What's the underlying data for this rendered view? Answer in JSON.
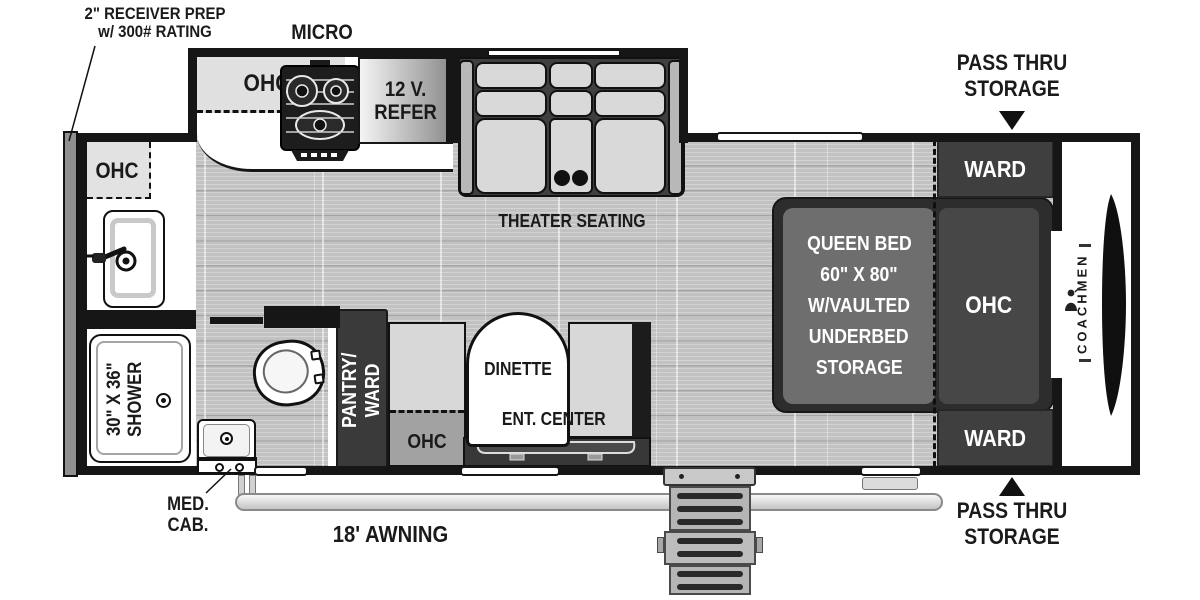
{
  "floorplan": {
    "brand": "COACHMEN",
    "annotations": {
      "receiver_prep": [
        "2\" RECEIVER PREP",
        "w/ 300# RATING"
      ],
      "micro": "MICRO",
      "pass_thru_top": [
        "PASS THRU",
        "STORAGE"
      ],
      "pass_thru_bottom": [
        "PASS THRU",
        "STORAGE"
      ],
      "awning": "18' AWNING",
      "med_cab": [
        "MED.",
        "CAB."
      ],
      "theater_seating": "THEATER SEATING"
    },
    "kitchen": {
      "ohc": "OHC",
      "refer": [
        "12 V.",
        "REFER"
      ]
    },
    "dinette": {
      "label": "DINETTE",
      "ent_center": "ENT. CENTER",
      "ohc": "OHC",
      "pantry": [
        "PANTRY/",
        "WARD"
      ]
    },
    "bedroom": {
      "ward_top": "WARD",
      "ward_bottom": "WARD",
      "ohc": "OHC",
      "queen_bed": [
        "QUEEN BED",
        "60\" X 80\"",
        "W/VAULTED",
        "UNDERBED",
        "STORAGE"
      ]
    },
    "bathroom": {
      "ohc": "OHC",
      "shower": [
        "30\" X 36\"",
        "SHOWER"
      ]
    },
    "colors": {
      "wall": "#161616",
      "floor": "#c2c2c2",
      "cabinet_dark": "#3f3f3f",
      "seat_light": "#d9d9d9",
      "mattress": "#6e6e6e",
      "white": "#ffffff"
    }
  }
}
